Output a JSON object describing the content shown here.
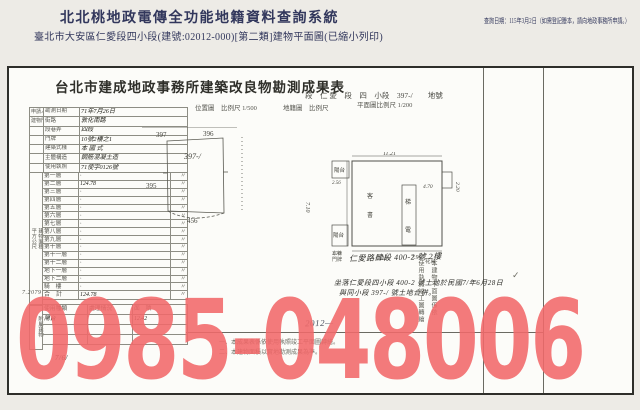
{
  "header": {
    "system_title": "北北桃地政電傳全功能地籍資料查詢系統",
    "query_date_note": "查詢日期：115年3月2日（如需登記謄本，請向地政事務所申請。）",
    "subtitle": "臺北市大安區仁愛段四小段(建號:02012-000)[第二類]建物平面圖(已縮小列印)"
  },
  "document": {
    "title": "台北市建成地政事務所建築改良物勘測成果表",
    "land_ref": "段　仁 愛　段　四　小段　397-/　　地號",
    "scales": {
      "site": "位置圖　比例尺 1/500",
      "cadastre": "地籍圖　比例尺",
      "plan": "平面圖比例尺 1/200"
    },
    "form": {
      "top_rows": [
        {
          "group": "申請人 姓名",
          "label": "勘測日期",
          "value": "71年7月26日",
          "wide": false
        },
        {
          "group": "建物門牌",
          "label": "街路",
          "value": "敦化南路",
          "wide": false
        },
        {
          "group": "",
          "label": "段巷弄",
          "value": "四段",
          "wide": false
        },
        {
          "group": "",
          "label": "門牌",
          "value": "10號2樓之1",
          "wide": false
        },
        {
          "group": "",
          "label": "建築式樣",
          "value": "本 國 式",
          "wide": true
        },
        {
          "group": "",
          "label": "主體構造",
          "value": "鋼筋混凝土造",
          "wide": true
        },
        {
          "group": "",
          "label": "使用執照",
          "value": "71使字0126號",
          "wide": true
        }
      ],
      "area_group_top": "建物面積",
      "area_group_bottom": "平方公尺",
      "floor_rows": [
        {
          "label": "第一層",
          "value": "·",
          "unit": "〃"
        },
        {
          "label": "第二層",
          "value": "124.78",
          "unit": "〃"
        },
        {
          "label": "第三層",
          "value": "·",
          "unit": "〃"
        },
        {
          "label": "第四層",
          "value": "·",
          "unit": "〃"
        },
        {
          "label": "第五層",
          "value": "·",
          "unit": "〃"
        },
        {
          "label": "第六層",
          "value": "·",
          "unit": "〃"
        },
        {
          "label": "第七層",
          "value": "·",
          "unit": "〃"
        },
        {
          "label": "第八層",
          "value": "·",
          "unit": "〃"
        },
        {
          "label": "第九層",
          "value": "·",
          "unit": "〃"
        },
        {
          "label": "第十層",
          "value": "·",
          "unit": "〃"
        },
        {
          "label": "第十一層",
          "value": "·",
          "unit": "〃"
        },
        {
          "label": "第十二層",
          "value": "·",
          "unit": "〃"
        },
        {
          "label": "地下一層",
          "value": "·",
          "unit": "〃"
        },
        {
          "label": "地下二層",
          "value": "·",
          "unit": "〃"
        },
        {
          "label": "騎　樓",
          "value": "·",
          "unit": "〃"
        }
      ],
      "total_row": {
        "label": "合　計",
        "value": "124.78",
        "unit": "〃"
      },
      "fee_note": "7.2079",
      "attached_group": "附屬建物",
      "attached_headers": [
        "使用種類",
        "處理情況",
        "面　積"
      ],
      "attached_rows": [
        [
          "陽台",
          "",
          "12.42"
        ],
        [
          "",
          "",
          ""
        ],
        [
          "",
          "",
          ""
        ]
      ]
    },
    "site_plan": {
      "nw": "397",
      "ne": "396",
      "center": "397-/",
      "west": "395",
      "south": "456"
    },
    "floor_plan": {
      "top": "11.21",
      "left_v": "7.10",
      "bottom_l": "7.10",
      "bottom_r": "7.90",
      "notch_v": "2.20",
      "notch_h": "4.70",
      "balcony_tl": "陽台",
      "balcony_tl_dim": "2.56",
      "balcony_bl": "陽台",
      "balcony_bl_dim": "1.70",
      "shaft_top": "梯",
      "shaft_bottom": "電",
      "room_a": "客",
      "room_b": "書",
      "flower": "花台"
    },
    "notes": {
      "addr_label": "本棟 門牌",
      "addr_value": "仁愛路肆段 400-2 號 2樓",
      "land_note_1": "坐落仁愛段四小段 400-2 號土地於民國7/年6月28日",
      "land_note_2": "與同小段 397-/ 號土地合併。",
      "vertical_note_1": "本建物平面圖係依",
      "vertical_note_2": "使用執照竣工圖轉繪",
      "check_mark": "✓",
      "remark_1": "一、本成果表係依使用執照竣工平面圖轉繪。",
      "remark_2": "二、本建物面積以實地勘測成果為準。",
      "hand_no": "2012—",
      "hand_date": "7/6/"
    }
  },
  "watermark": {
    "text": "0985-048006",
    "color": "#f2696a"
  }
}
